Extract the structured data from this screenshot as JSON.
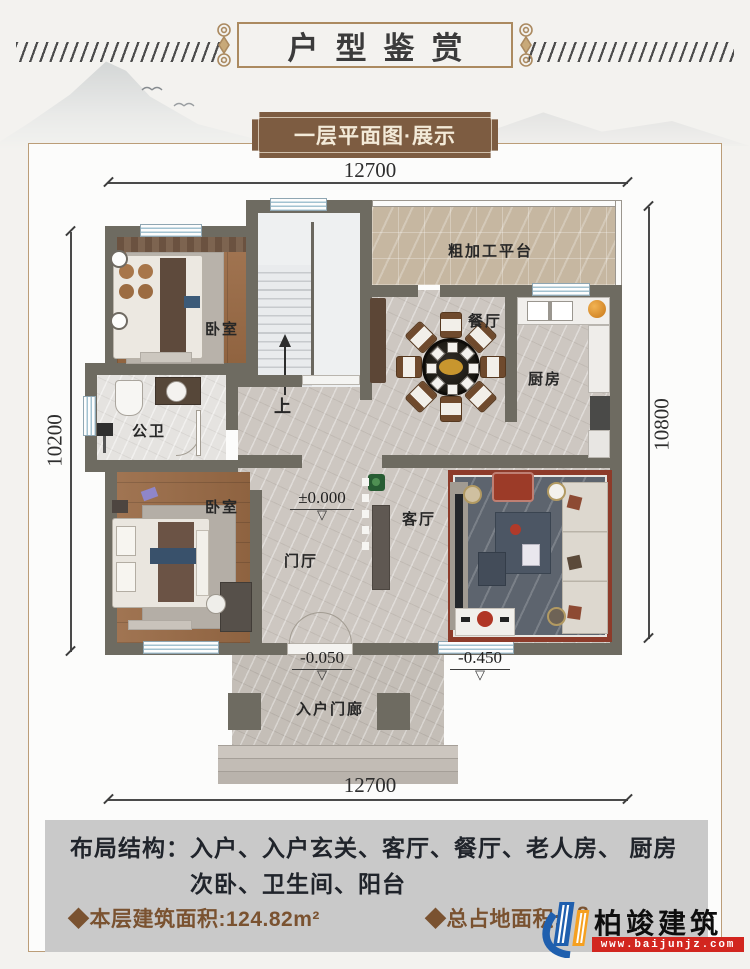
{
  "header": {
    "title": "户型鉴赏"
  },
  "banner": {
    "label": "一层平面图·展示"
  },
  "plan": {
    "dimensions": {
      "top": "12700",
      "bottom": "12700",
      "left": "10200",
      "right": "10800"
    },
    "rooms": {
      "bedroom_top": "卧室",
      "bedroom_bottom": "卧室",
      "bathroom": "公卫",
      "dining": "餐厅",
      "kitchen": "厨房",
      "platform": "粗加工平台",
      "foyer": "门厅",
      "living": "客厅",
      "porch": "入户门廊"
    },
    "stairs": {
      "up_label": "上"
    },
    "elevations": {
      "foyer": "±0.000",
      "porch": "-0.050",
      "terrace": "-0.450"
    }
  },
  "footer": {
    "layout_label": "布局结构：",
    "layout_line1": "入户、入户玄关、客厅、餐厅、老人房、 厨房",
    "layout_line2": "次卧、卫生间、阳台",
    "area_floor": "◆本层建筑面积:124.82m²",
    "area_site_label": "◆总占地面积:",
    "area_site_partial": "8"
  },
  "logo": {
    "brand": "柏竣建筑",
    "website": "www.baijunjz.com"
  },
  "colors": {
    "wall": "#6e6b61",
    "wood_floor": "#9b6b45",
    "marble_floor": "#cdc7c1",
    "platform_tile": "#c6b7a1",
    "panel_gray": "#c9c9c9",
    "accent_brown": "#7a5230",
    "banner_brown": "#7d5c41",
    "frame_gold": "#ab8a60",
    "logo_blue": "#1f5fae",
    "logo_orange": "#f5a020",
    "logo_red": "#d2261f"
  }
}
